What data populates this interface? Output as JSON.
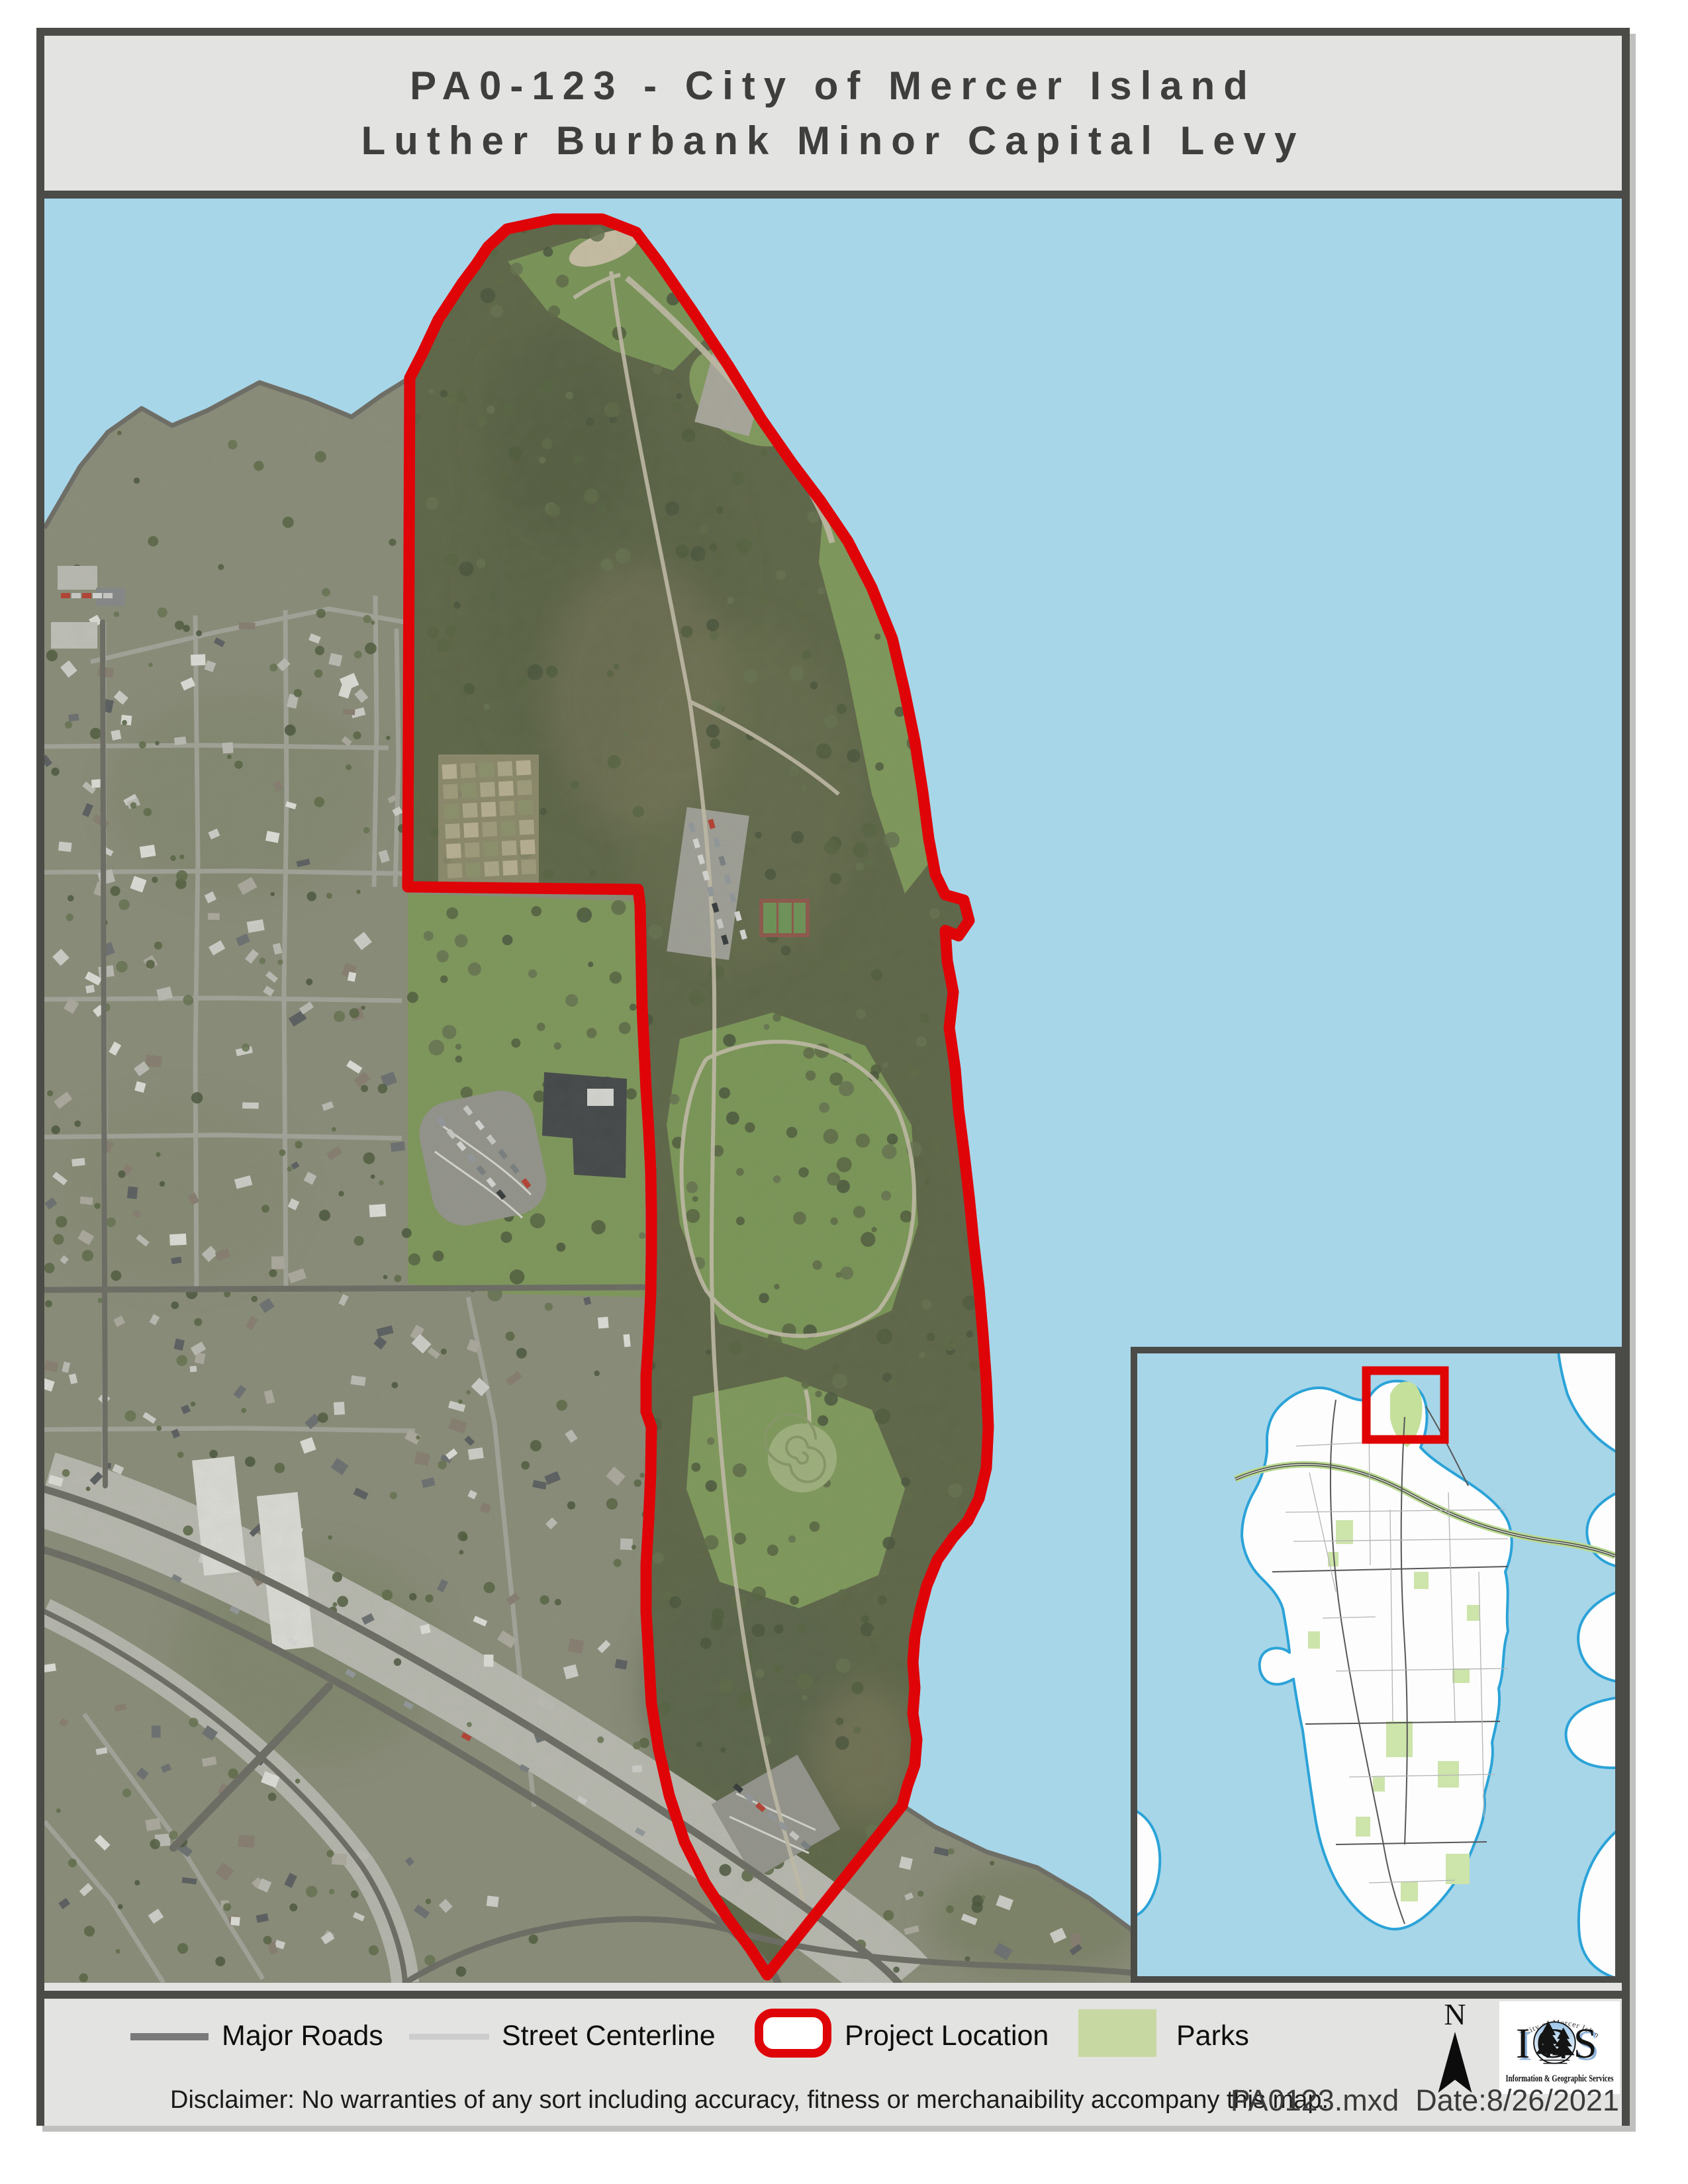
{
  "title": {
    "line1": "PA0-123 - City of Mercer Island",
    "line2": "Luther Burbank Minor Capital Levy"
  },
  "legend": {
    "items": [
      {
        "label": "Major Roads",
        "swatch": "line",
        "color": "#7a7a7a"
      },
      {
        "label": "Street Centerline",
        "swatch": "line",
        "color": "#cdcdcd"
      },
      {
        "label": "Project Location",
        "swatch": "outline",
        "color": "#df0408"
      },
      {
        "label": "Parks",
        "swatch": "fill",
        "color": "#c8d8a2"
      }
    ]
  },
  "north_arrow": {
    "label": "N"
  },
  "logo": {
    "arc_text": "City of Mercer Island",
    "acronym": "IGS",
    "subtitle": "Information & Geographic Services"
  },
  "notes": {
    "disclaimer": "Disclaimer: No warranties of any sort including accuracy, fitness or merchanaibility accompany this map.",
    "file_date": "PA0123.mxd  Date:8/26/2021"
  },
  "map_colors": {
    "water": "#a7d6e9",
    "project_boundary": "#df0408",
    "inset_indicator": "#e00404",
    "inset_shoreline": "#2ba3d8",
    "frame": "#4b4b47"
  }
}
